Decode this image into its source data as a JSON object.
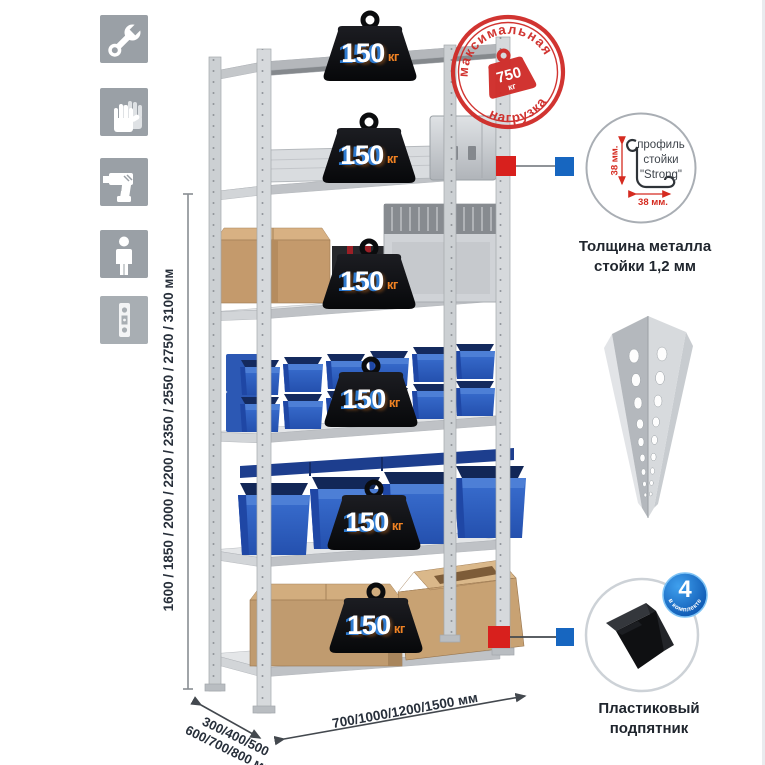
{
  "stamp": {
    "arc_top": "максимальная",
    "arc_bottom": "нагрузка",
    "weight_value": "750",
    "weight_unit": "кг"
  },
  "load_badge": {
    "value": "150",
    "unit": "кг",
    "count_shown": 6
  },
  "dimensions": {
    "height": "1600 / 1850 / 2000 / 2200 / 2350 / 2550 / 2750 / 3100 мм",
    "depth_line1": "300/400/500",
    "depth_line2": "600/700/800 мм",
    "width": "700/1000/1200/1500 мм"
  },
  "profile_detail": {
    "label_line1": "профиль",
    "label_line2": "стойки",
    "label_line3": "\"Strong\"",
    "dim_vertical": "38 мм.",
    "dim_horizontal": "38 мм.",
    "caption_line1": "Толщина металла",
    "caption_line2": "стойки 1,2 мм"
  },
  "foot_detail": {
    "badge_value": "4",
    "badge_caption": "в комплекте",
    "caption_line1": "Пластиковый",
    "caption_line2": "подпятник"
  },
  "icons": [
    "wrench-icon",
    "gloves-icon",
    "drill-icon",
    "person-icon",
    "perforated-strip-icon"
  ],
  "colors": {
    "stamp_red": "#cf2a26",
    "marker_red": "#d8201d",
    "marker_blue": "#1766c0",
    "bin_blue": "#2e62c4",
    "icon_gray": "#9aa0a6",
    "metal_gray": "#d2d5d8",
    "cardboard": "#c49a6c",
    "badge_black": "#0e0f12",
    "unit_orange": "#f08223"
  }
}
